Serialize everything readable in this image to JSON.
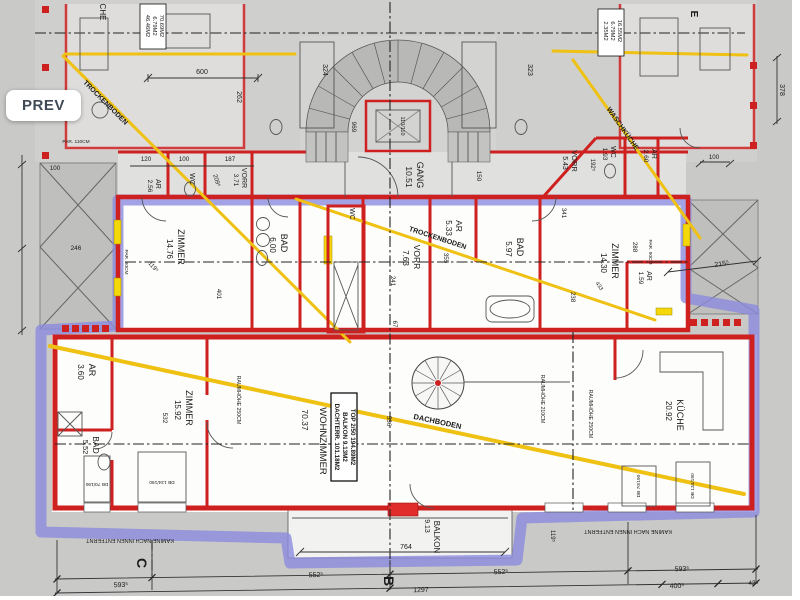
{
  "viewer": {
    "prev_label": "PREV"
  },
  "plan": {
    "colors": {
      "wall_red": "#cf2020",
      "unit_outline_purple": "#8b8bdf",
      "attic_yellow": "#efc113",
      "window_sill_yellow": "#f4d80a",
      "plan_background": "#c9c9c7",
      "room_white": "#fdfdfb",
      "prev_text": "#3f4a56"
    },
    "room_labels": [
      {
        "t": "ZIMMER",
        "x": 178,
        "y": 247,
        "r": 90,
        "s": 9
      },
      {
        "t": "14.76",
        "x": 167,
        "y": 249,
        "r": 90,
        "s": 8
      },
      {
        "t": "BAD",
        "x": 281,
        "y": 243,
        "r": 90,
        "s": 9
      },
      {
        "t": "6.00",
        "x": 270,
        "y": 245,
        "r": 90,
        "s": 8
      },
      {
        "t": "WC",
        "x": 350,
        "y": 214,
        "r": 90,
        "s": 7
      },
      {
        "t": "VORR",
        "x": 414,
        "y": 257,
        "r": 90,
        "s": 8.5
      },
      {
        "t": "7.63",
        "x": 403,
        "y": 258,
        "r": 90,
        "s": 8
      },
      {
        "t": "AR",
        "x": 456,
        "y": 226,
        "r": 90,
        "s": 8.5
      },
      {
        "t": "5.33",
        "x": 446,
        "y": 228,
        "r": 90,
        "s": 8
      },
      {
        "t": "BAD",
        "x": 517,
        "y": 247,
        "r": 90,
        "s": 9
      },
      {
        "t": "5.97",
        "x": 506,
        "y": 249,
        "r": 90,
        "s": 8
      },
      {
        "t": "ZIMMER",
        "x": 612,
        "y": 261,
        "r": 90,
        "s": 9
      },
      {
        "t": "14.30",
        "x": 601,
        "y": 263,
        "r": 90,
        "s": 8
      },
      {
        "t": "AR",
        "x": 647,
        "y": 276,
        "r": 90,
        "s": 7
      },
      {
        "t": "1.59",
        "x": 639,
        "y": 278,
        "r": 90,
        "s": 6.5
      },
      {
        "t": "GANG",
        "x": 417,
        "y": 175,
        "r": 90,
        "s": 9
      },
      {
        "t": "10.51",
        "x": 406,
        "y": 177,
        "r": 90,
        "s": 8.5
      },
      {
        "t": "AR",
        "x": 156,
        "y": 184,
        "r": 90,
        "s": 7
      },
      {
        "t": "2.56",
        "x": 148,
        "y": 186,
        "r": 90,
        "s": 6.5
      },
      {
        "t": "WC",
        "x": 190,
        "y": 179,
        "r": 90,
        "s": 7
      },
      {
        "t": "VORR",
        "x": 242,
        "y": 178,
        "r": 90,
        "s": 7
      },
      {
        "t": "3.71",
        "x": 234,
        "y": 180,
        "r": 90,
        "s": 6.5
      },
      {
        "t": "VORR",
        "x": 572,
        "y": 161,
        "r": 90,
        "s": 7.5
      },
      {
        "t": "5.43",
        "x": 563,
        "y": 163,
        "r": 90,
        "s": 7
      },
      {
        "t": "WC",
        "x": 611,
        "y": 152,
        "r": 90,
        "s": 7
      },
      {
        "t": "1.93",
        "x": 603,
        "y": 154,
        "r": 90,
        "s": 6.5
      },
      {
        "t": "AR",
        "x": 652,
        "y": 154,
        "r": 90,
        "s": 7
      },
      {
        "t": "2.60",
        "x": 644,
        "y": 156,
        "r": 90,
        "s": 6.5
      },
      {
        "t": "AR",
        "x": 89,
        "y": 370,
        "r": 90,
        "s": 9
      },
      {
        "t": "3.60",
        "x": 78,
        "y": 372,
        "r": 90,
        "s": 8
      },
      {
        "t": "ZIMMER",
        "x": 186,
        "y": 408,
        "r": 90,
        "s": 9
      },
      {
        "t": "15.92",
        "x": 175,
        "y": 410,
        "r": 90,
        "s": 8
      },
      {
        "t": "532",
        "x": 163,
        "y": 418,
        "r": 90,
        "s": 6.5
      },
      {
        "t": "BAD",
        "x": 93,
        "y": 445,
        "r": 90,
        "s": 8.5
      },
      {
        "t": "5.52",
        "x": 83,
        "y": 447,
        "r": 90,
        "s": 7.5
      },
      {
        "t": "WOHNZIMMER",
        "x": 320,
        "y": 441,
        "r": 90,
        "s": 9.5
      },
      {
        "t": "70.37",
        "x": 302,
        "y": 420,
        "r": 90,
        "s": 8.5
      },
      {
        "t": "KÜCHE",
        "x": 677,
        "y": 415,
        "r": 90,
        "s": 9
      },
      {
        "t": "20.92",
        "x": 666,
        "y": 411,
        "r": 90,
        "s": 8
      },
      {
        "t": "BALKON",
        "x": 434,
        "y": 537,
        "r": 90,
        "s": 8
      },
      {
        "t": "9.13",
        "x": 425,
        "y": 526,
        "r": 90,
        "s": 7
      },
      {
        "t": "CHE",
        "x": 100,
        "y": 12,
        "r": 90,
        "s": 8,
        "c": "#3a3a3a"
      }
    ],
    "axis_labels": [
      {
        "t": "B",
        "x": 384,
        "y": 581,
        "r": 90,
        "s": 14,
        "b": 1
      },
      {
        "t": "C",
        "x": 137,
        "y": 563,
        "r": 90,
        "s": 14,
        "b": 1
      },
      {
        "t": "E",
        "x": 691,
        "y": 14,
        "r": 90,
        "s": 10,
        "b": 1
      }
    ],
    "area_labels": [
      {
        "t": "TOP 2/50 194.89M2",
        "x": 351,
        "y": 437,
        "r": 90,
        "s": 6.3,
        "b": 1
      },
      {
        "t": "BALKON 9.13M2",
        "x": 343,
        "y": 437,
        "r": 90,
        "s": 6.3,
        "b": 1
      },
      {
        "t": "DACHTERR. 101.18M2",
        "x": 335,
        "y": 437,
        "r": 90,
        "s": 6.3,
        "b": 1
      },
      {
        "t": "70.69M2",
        "x": 160,
        "y": 26,
        "r": 90,
        "s": 5.8
      },
      {
        "t": "6.79M2",
        "x": 153,
        "y": 26,
        "r": 90,
        "s": 5.8
      },
      {
        "t": "46.46M2",
        "x": 146,
        "y": 26,
        "r": 90,
        "s": 5.8
      },
      {
        "t": "16.55M2",
        "x": 618,
        "y": 31,
        "r": 90,
        "s": 5.8
      },
      {
        "t": "6.79M2",
        "x": 611,
        "y": 31,
        "r": 90,
        "s": 5.8
      },
      {
        "t": "2.35M2",
        "x": 604,
        "y": 31,
        "r": 90,
        "s": 5.8
      }
    ],
    "attic_labels": [
      {
        "t": "TROCKENBODEN",
        "x": 104,
        "y": 104,
        "r": 45,
        "s": 7,
        "c": "#8a6d00",
        "b": 1
      },
      {
        "t": "TROCKENBODEN",
        "x": 437,
        "y": 240,
        "r": 18,
        "s": 7,
        "c": "#8a6d00",
        "b": 1
      },
      {
        "t": "WASCHKÜCHE",
        "x": 621,
        "y": 130,
        "r": 55,
        "s": 7,
        "c": "#8a6d00",
        "b": 1
      },
      {
        "t": "DACHBODEN",
        "x": 437,
        "y": 424,
        "r": 12,
        "s": 7.5,
        "c": "#8a6d00",
        "b": 1
      }
    ],
    "note_labels": [
      {
        "t": "KAMINE NACH INNEN ENTFERNT",
        "x": 130,
        "y": 539,
        "r": 180,
        "s": 5.5,
        "c": "#333"
      },
      {
        "t": "KAMINE NACH INNEN ENTFERNT",
        "x": 628,
        "y": 530,
        "r": 180,
        "s": 5.5,
        "c": "#333"
      },
      {
        "t": "RAUMHÖHE 210CM",
        "x": 541,
        "y": 399,
        "r": 90,
        "s": 5.2,
        "c": "#333"
      },
      {
        "t": "RAUMHÖHE 250CM",
        "x": 589,
        "y": 414,
        "r": 90,
        "s": 5.2,
        "c": "#333"
      },
      {
        "t": "RAUMHÖHE 250CM",
        "x": 237,
        "y": 400,
        "r": 90,
        "s": 5.2,
        "c": "#333"
      },
      {
        "t": "PAR. 110CM",
        "x": 76,
        "y": 143,
        "s": 4.8,
        "c": "#444"
      },
      {
        "t": "PAR. 80CM",
        "x": 125,
        "y": 262,
        "r": 90,
        "s": 4.8,
        "c": "#444"
      },
      {
        "t": "PAR. 90CM",
        "x": 649,
        "y": 252,
        "r": 90,
        "s": 4.8,
        "c": "#444"
      },
      {
        "t": "DB 70/190",
        "x": 97,
        "y": 483,
        "r": 180,
        "s": 4.8,
        "c": "#444"
      },
      {
        "t": "DB 134/190",
        "x": 162,
        "y": 481,
        "r": 180,
        "s": 4.8,
        "c": "#444"
      },
      {
        "t": "DB 70/190",
        "x": 640,
        "y": 486,
        "r": -90,
        "s": 4.8,
        "c": "#444"
      },
      {
        "t": "DB 134/190",
        "x": 694,
        "y": 486,
        "r": -90,
        "s": 4.8,
        "c": "#444"
      }
    ],
    "dimension_labels": [
      {
        "t": "600",
        "x": 202,
        "y": 74,
        "s": 7
      },
      {
        "t": "324",
        "x": 323,
        "y": 70,
        "r": 90,
        "s": 7
      },
      {
        "t": "323",
        "x": 528,
        "y": 70,
        "r": 90,
        "s": 7
      },
      {
        "t": "262",
        "x": 237,
        "y": 97,
        "r": 90,
        "s": 7
      },
      {
        "t": "969",
        "x": 352,
        "y": 127,
        "r": 90,
        "s": 6.5
      },
      {
        "t": "120",
        "x": 146,
        "y": 161,
        "s": 6.2
      },
      {
        "t": "100",
        "x": 184,
        "y": 161,
        "s": 6.2
      },
      {
        "t": "187",
        "x": 230,
        "y": 161,
        "s": 6.2
      },
      {
        "t": "209⁵",
        "x": 215,
        "y": 181,
        "r": 72,
        "s": 6
      },
      {
        "t": "150",
        "x": 477,
        "y": 176,
        "r": 90,
        "s": 6.2
      },
      {
        "t": "192⁵",
        "x": 591,
        "y": 165,
        "r": 90,
        "s": 6
      },
      {
        "t": "100",
        "x": 55,
        "y": 170,
        "s": 6.2
      },
      {
        "t": "246",
        "x": 76,
        "y": 250,
        "s": 6.5
      },
      {
        "t": "100",
        "x": 714,
        "y": 159,
        "s": 6.2
      },
      {
        "t": "341",
        "x": 562,
        "y": 213,
        "r": 90,
        "s": 6.2
      },
      {
        "t": "288",
        "x": 633,
        "y": 247,
        "r": 90,
        "s": 6.2
      },
      {
        "t": "238",
        "x": 571,
        "y": 297,
        "r": 90,
        "s": 6.2
      },
      {
        "t": "433",
        "x": 598,
        "y": 287,
        "r": 55,
        "s": 5.5
      },
      {
        "t": "215⁵",
        "x": 722,
        "y": 266,
        "r": -8,
        "s": 7
      },
      {
        "t": "119⁵",
        "x": 152,
        "y": 268,
        "r": 48,
        "s": 6
      },
      {
        "t": "401",
        "x": 217,
        "y": 294,
        "r": 90,
        "s": 6.2
      },
      {
        "t": "241",
        "x": 391,
        "y": 281,
        "r": 90,
        "s": 6.2
      },
      {
        "t": "355",
        "x": 444,
        "y": 258,
        "r": 90,
        "s": 6.2
      },
      {
        "t": "536",
        "x": 387,
        "y": 421,
        "r": 90,
        "s": 6.2
      },
      {
        "t": "67",
        "x": 393,
        "y": 324,
        "r": 90,
        "s": 6
      },
      {
        "t": "764",
        "x": 406,
        "y": 549,
        "s": 7
      },
      {
        "t": "552⁵",
        "x": 316,
        "y": 577,
        "r": -2,
        "s": 7
      },
      {
        "t": "552⁵",
        "x": 501,
        "y": 574,
        "r": -2,
        "s": 7
      },
      {
        "t": "593⁵",
        "x": 682,
        "y": 571,
        "r": -2,
        "s": 7
      },
      {
        "t": "593⁵",
        "x": 121,
        "y": 587,
        "r": -2,
        "s": 7
      },
      {
        "t": "1297",
        "x": 421,
        "y": 592,
        "r": -2,
        "s": 7
      },
      {
        "t": "400⁵",
        "x": 677,
        "y": 588,
        "r": -2,
        "s": 7
      },
      {
        "t": "42",
        "x": 752,
        "y": 585,
        "r": -2,
        "s": 6.5
      },
      {
        "t": "378",
        "x": 780,
        "y": 90,
        "r": 90,
        "s": 7
      },
      {
        "t": "119⁵",
        "x": 551,
        "y": 536,
        "r": 90,
        "s": 6
      }
    ],
    "misc_labels": [
      {
        "t": "110/110",
        "x": 401,
        "y": 126,
        "r": 90,
        "s": 5.5,
        "c": "#333"
      }
    ],
    "attic_lines": [
      {
        "x1": 65,
        "y1": 54,
        "x2": 295,
        "y2": 54,
        "w": 3
      },
      {
        "x1": 553,
        "y1": 51,
        "x2": 747,
        "y2": 55,
        "w": 3
      },
      {
        "x1": 63,
        "y1": 56,
        "x2": 350,
        "y2": 342,
        "w": 3
      },
      {
        "x1": 296,
        "y1": 199,
        "x2": 655,
        "y2": 320,
        "w": 3
      },
      {
        "x1": 573,
        "y1": 60,
        "x2": 700,
        "y2": 238,
        "w": 3
      },
      {
        "x1": 50,
        "y1": 346,
        "x2": 744,
        "y2": 494,
        "w": 4
      }
    ]
  }
}
